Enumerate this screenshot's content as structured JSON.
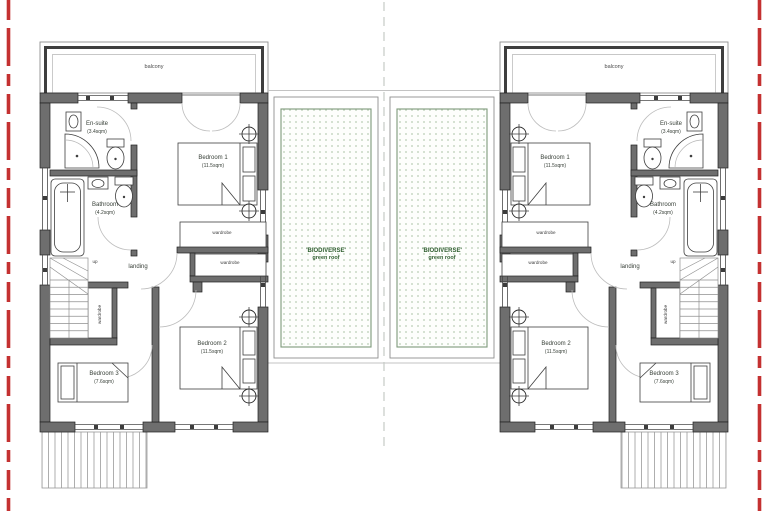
{
  "plan": {
    "units": [
      {
        "side": "left",
        "balcony_label": "balcony",
        "landing_label": "landing",
        "stairs_label": "up",
        "wardrobe_labels": [
          "wardrobe",
          "wardrobe",
          "wardrobe"
        ],
        "rooms": [
          {
            "name": "En-suite",
            "area": "(3.4sqm)"
          },
          {
            "name": "Bedroom 1",
            "area": "(11.5sqm)"
          },
          {
            "name": "Bathroom",
            "area": "(4.2sqm)"
          },
          {
            "name": "Bedroom 2",
            "area": "(11.5sqm)"
          },
          {
            "name": "Bedroom 3",
            "area": "(7.6sqm)"
          }
        ]
      },
      {
        "side": "right",
        "balcony_label": "balcony",
        "landing_label": "landing",
        "stairs_label": "up",
        "wardrobe_labels": [
          "wardrobe",
          "wardrobe",
          "wardrobe"
        ],
        "rooms": [
          {
            "name": "En-suite",
            "area": "(3.4sqm)"
          },
          {
            "name": "Bedroom 1",
            "area": "(11.5sqm)"
          },
          {
            "name": "Bathroom",
            "area": "(4.2sqm)"
          },
          {
            "name": "Bedroom 2",
            "area": "(11.5sqm)"
          },
          {
            "name": "Bedroom 3",
            "area": "(7.6sqm)"
          }
        ]
      }
    ],
    "green_roofs": [
      {
        "label_line1": "'BIODIVERSE'",
        "label_line2": "green roof"
      },
      {
        "label_line1": "'BIODIVERSE'",
        "label_line2": "green roof"
      }
    ]
  },
  "colors": {
    "wall_gray": "#6e6e6e",
    "boundary_red": "#c43131",
    "green_roof_border": "#7d997a",
    "green_roof_dot": "#b9cdb5",
    "green_roof_text": "#2f5e2f",
    "background": "#ffffff"
  }
}
